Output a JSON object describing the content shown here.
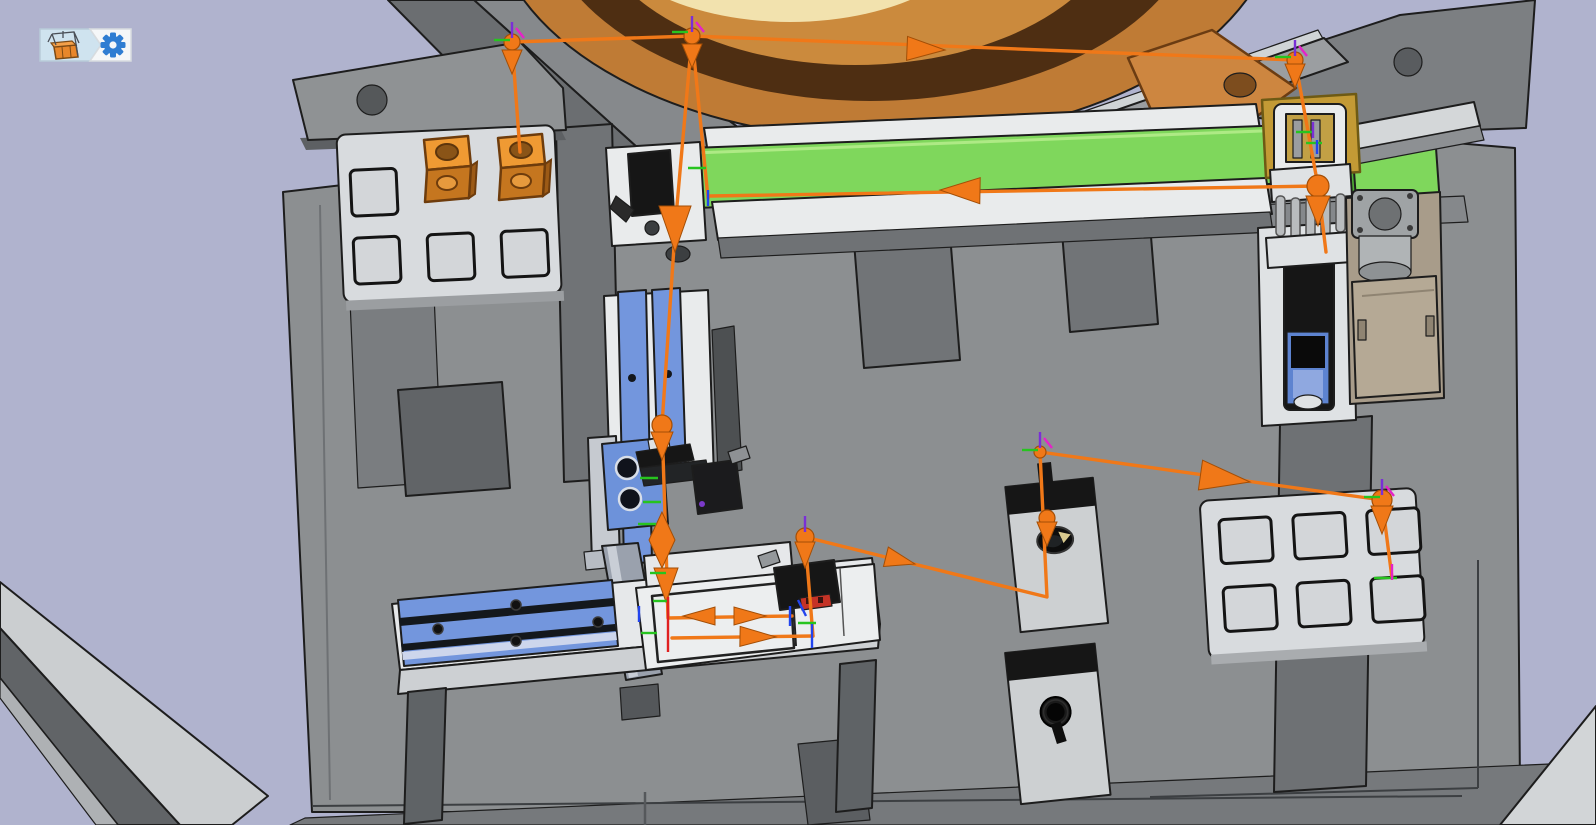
{
  "toolbar": {
    "buttons": [
      {
        "name": "machine-view",
        "icon": "machine-3d-icon",
        "tooltip": "machine"
      },
      {
        "name": "settings",
        "icon": "gear-icon",
        "tooltip": "settings"
      }
    ]
  },
  "colors": {
    "bg": "#b0b3ce",
    "base": "#8c8f91",
    "base-dark": "#646769",
    "base-mid": "#76797c",
    "frame": "#6b6e71",
    "frame-light": "#9b9ea1",
    "white-part": "#e9ebec",
    "white-shade": "#cdd0d3",
    "tray": "#d8dbde",
    "tray-pocket": "#d3d6d9",
    "outline": "#1d1d1d",
    "block-top": "#ef9a33",
    "block-front": "#c5761f",
    "bowl-outer": "#bf7b35",
    "bowl-band": "#4e2e12",
    "bowl-inner": "#cb8a3d",
    "bowl-pale": "#f2e2ae",
    "bowl-center": "#f9f0d0",
    "bowl-tab": "#cd8640",
    "belt": "#7fd75c",
    "belt-dark": "#4fae35",
    "gold": "#c39a35",
    "blue-rail": "#7396dd",
    "blue-block": "#6d92da",
    "steel": "#9aa1ad",
    "tan": "#b5a995",
    "tan-dark": "#a89c8a",
    "black-part": "#161616",
    "traj": "#f07818",
    "red-label": "#c53326",
    "icon-blue": "#2f7dd2",
    "icon-bg": "#cfe3ef",
    "axis-green": "#27c41f",
    "axis-blue": "#2244ee",
    "axis-purple": "#7a2fd6",
    "axis-magenta": "#e522c8",
    "axis-red": "#e02020"
  },
  "scene": {
    "components": [
      "bowl-feeder",
      "feeder-tab",
      "belt-conveyor",
      "conveyor-left-bracket",
      "photoelectric-sensor",
      "gripper-station",
      "gold-bracket",
      "stepper-motor",
      "pallet-tray-left",
      "orange-workpiece-1",
      "orange-workpiece-2",
      "vertical-slide-tower",
      "horizontal-linear-slide",
      "work-table",
      "assembly-fixture",
      "fixture-sensor",
      "station-a-socket",
      "station-b-knob",
      "pallet-tray-right",
      "base-plate",
      "frame-beams"
    ]
  },
  "trajectory": {
    "stroke_width": 3.4,
    "paths": [
      [
        [
          520,
          152
        ],
        [
          512,
          42
        ],
        [
          692,
          36
        ],
        [
          1295,
          60
        ],
        [
          1318,
          186
        ],
        [
          1326,
          252
        ]
      ],
      [
        [
          692,
          36
        ],
        [
          675,
          228
        ]
      ],
      [
        [
          692,
          36
        ],
        [
          708,
          198
        ]
      ],
      [
        [
          710,
          196
        ],
        [
          1318,
          186
        ]
      ],
      [
        [
          675,
          232
        ],
        [
          662,
          425
        ],
        [
          666,
          545
        ],
        [
          668,
          618
        ],
        [
          792,
          616
        ]
      ],
      [
        [
          672,
          638
        ],
        [
          813,
          636
        ]
      ],
      [
        [
          805,
          537
        ],
        [
          813,
          636
        ]
      ],
      [
        [
          805,
          537
        ],
        [
          1047,
          597
        ],
        [
          1040,
          452
        ]
      ],
      [
        [
          1040,
          452
        ],
        [
          1382,
          500
        ],
        [
          1392,
          578
        ]
      ]
    ],
    "markers": [
      {
        "t": "ball",
        "x": 512,
        "y": 42,
        "r": 8
      },
      {
        "t": "cone",
        "x": 512,
        "y": 74,
        "len": 24,
        "hw": 10,
        "ang": 90
      },
      {
        "t": "ball",
        "x": 692,
        "y": 36,
        "r": 8
      },
      {
        "t": "cone",
        "x": 692,
        "y": 68,
        "len": 24,
        "hw": 10,
        "ang": 90
      },
      {
        "t": "ball",
        "x": 1295,
        "y": 60,
        "r": 8
      },
      {
        "t": "cone",
        "x": 1295,
        "y": 88,
        "len": 24,
        "hw": 10,
        "ang": 90
      },
      {
        "t": "ball",
        "x": 1318,
        "y": 186,
        "r": 11
      },
      {
        "t": "cone",
        "x": 1318,
        "y": 226,
        "len": 30,
        "hw": 12,
        "ang": 90
      },
      {
        "t": "cone",
        "x": 675,
        "y": 252,
        "len": 46,
        "hw": 16,
        "ang": 90
      },
      {
        "t": "ball",
        "x": 662,
        "y": 425,
        "r": 10
      },
      {
        "t": "cone",
        "x": 662,
        "y": 460,
        "len": 28,
        "hw": 11,
        "ang": 90
      },
      {
        "t": "poly",
        "pts": "662,512 649,540 662,568 675,540"
      },
      {
        "t": "cone",
        "x": 666,
        "y": 602,
        "len": 34,
        "hw": 12,
        "ang": 90
      },
      {
        "t": "cone",
        "x": 683,
        "y": 616,
        "len": 32,
        "hw": 9,
        "ang": 180
      },
      {
        "t": "cone",
        "x": 766,
        "y": 616,
        "len": 32,
        "hw": 9,
        "ang": 0
      },
      {
        "t": "cone",
        "x": 776,
        "y": 637,
        "len": 36,
        "hw": 10,
        "ang": 1
      },
      {
        "t": "cone",
        "x": 945,
        "y": 50,
        "len": 38,
        "hw": 12,
        "ang": 2.4
      },
      {
        "t": "cone",
        "x": 940,
        "y": 190,
        "len": 40,
        "hw": 13,
        "ang": 181
      },
      {
        "t": "ball",
        "x": 805,
        "y": 537,
        "r": 9
      },
      {
        "t": "cone",
        "x": 805,
        "y": 568,
        "len": 26,
        "hw": 10,
        "ang": 90
      },
      {
        "t": "cone",
        "x": 915,
        "y": 564,
        "len": 30,
        "hw": 10,
        "ang": 14
      },
      {
        "t": "ball",
        "x": 1047,
        "y": 518,
        "r": 8
      },
      {
        "t": "cone",
        "x": 1047,
        "y": 546,
        "len": 24,
        "hw": 10,
        "ang": 90
      },
      {
        "t": "ball",
        "x": 1040,
        "y": 452,
        "r": 6
      },
      {
        "t": "cone",
        "x": 1250,
        "y": 482,
        "len": 50,
        "hw": 15,
        "ang": 8
      },
      {
        "t": "ball",
        "x": 1382,
        "y": 500,
        "r": 10
      },
      {
        "t": "cone",
        "x": 1382,
        "y": 534,
        "len": 28,
        "hw": 11,
        "ang": 90
      }
    ],
    "ticks": [
      {
        "x1": 494,
        "y1": 40,
        "x2": 510,
        "y2": 40,
        "c": "green"
      },
      {
        "x1": 672,
        "y1": 32,
        "x2": 688,
        "y2": 32,
        "c": "green"
      },
      {
        "x1": 1275,
        "y1": 57,
        "x2": 1291,
        "y2": 57,
        "c": "green"
      },
      {
        "x1": 1296,
        "y1": 132,
        "x2": 1314,
        "y2": 132,
        "c": "green"
      },
      {
        "x1": 1306,
        "y1": 143,
        "x2": 1322,
        "y2": 143,
        "c": "green"
      },
      {
        "x1": 688,
        "y1": 168,
        "x2": 706,
        "y2": 168,
        "c": "green"
      },
      {
        "x1": 1022,
        "y1": 450,
        "x2": 1038,
        "y2": 450,
        "c": "green"
      },
      {
        "x1": 1364,
        "y1": 497,
        "x2": 1380,
        "y2": 497,
        "c": "green"
      },
      {
        "x1": 1374,
        "y1": 578,
        "x2": 1397,
        "y2": 578,
        "c": "green"
      },
      {
        "x1": 640,
        "y1": 478,
        "x2": 658,
        "y2": 478,
        "c": "green"
      },
      {
        "x1": 643,
        "y1": 502,
        "x2": 661,
        "y2": 502,
        "c": "green"
      },
      {
        "x1": 638,
        "y1": 524,
        "x2": 656,
        "y2": 524,
        "c": "green"
      },
      {
        "x1": 650,
        "y1": 573,
        "x2": 666,
        "y2": 573,
        "c": "green"
      },
      {
        "x1": 653,
        "y1": 601,
        "x2": 669,
        "y2": 601,
        "c": "green"
      },
      {
        "x1": 641,
        "y1": 633,
        "x2": 657,
        "y2": 633,
        "c": "green"
      },
      {
        "x1": 798,
        "y1": 623,
        "x2": 816,
        "y2": 623,
        "c": "green"
      },
      {
        "x1": 512,
        "y1": 22,
        "x2": 512,
        "y2": 38,
        "c": "purple"
      },
      {
        "x1": 692,
        "y1": 16,
        "x2": 692,
        "y2": 32,
        "c": "purple"
      },
      {
        "x1": 1295,
        "y1": 40,
        "x2": 1295,
        "y2": 56,
        "c": "purple"
      },
      {
        "x1": 1040,
        "y1": 432,
        "x2": 1040,
        "y2": 448,
        "c": "purple"
      },
      {
        "x1": 1382,
        "y1": 479,
        "x2": 1382,
        "y2": 495,
        "c": "purple"
      },
      {
        "x1": 805,
        "y1": 516,
        "x2": 805,
        "y2": 532,
        "c": "purple"
      },
      {
        "x1": 1313,
        "y1": 122,
        "x2": 1313,
        "y2": 138,
        "c": "purple"
      },
      {
        "x1": 516,
        "y1": 28,
        "x2": 524,
        "y2": 38,
        "c": "magenta"
      },
      {
        "x1": 696,
        "y1": 22,
        "x2": 704,
        "y2": 32,
        "c": "magenta"
      },
      {
        "x1": 1299,
        "y1": 46,
        "x2": 1307,
        "y2": 56,
        "c": "magenta"
      },
      {
        "x1": 1044,
        "y1": 438,
        "x2": 1052,
        "y2": 448,
        "c": "magenta"
      },
      {
        "x1": 1386,
        "y1": 486,
        "x2": 1394,
        "y2": 496,
        "c": "magenta"
      },
      {
        "x1": 1392,
        "y1": 564,
        "x2": 1392,
        "y2": 580,
        "c": "magenta"
      },
      {
        "x1": 708,
        "y1": 190,
        "x2": 708,
        "y2": 206,
        "c": "blue"
      },
      {
        "x1": 790,
        "y1": 606,
        "x2": 790,
        "y2": 626,
        "c": "blue"
      },
      {
        "x1": 812,
        "y1": 624,
        "x2": 812,
        "y2": 648,
        "c": "blue"
      },
      {
        "x1": 639,
        "y1": 606,
        "x2": 639,
        "y2": 622,
        "c": "blue"
      },
      {
        "x1": 798,
        "y1": 600,
        "x2": 806,
        "y2": 616,
        "c": "blue"
      },
      {
        "x1": 1317,
        "y1": 140,
        "x2": 1317,
        "y2": 154,
        "c": "blue"
      },
      {
        "x1": 668,
        "y1": 597,
        "x2": 668,
        "y2": 652,
        "c": "red"
      }
    ],
    "tick_colors": {
      "green": "#27c41f",
      "blue": "#2244ee",
      "purple": "#7a2fd6",
      "magenta": "#e522c8",
      "red": "#e02020"
    }
  }
}
